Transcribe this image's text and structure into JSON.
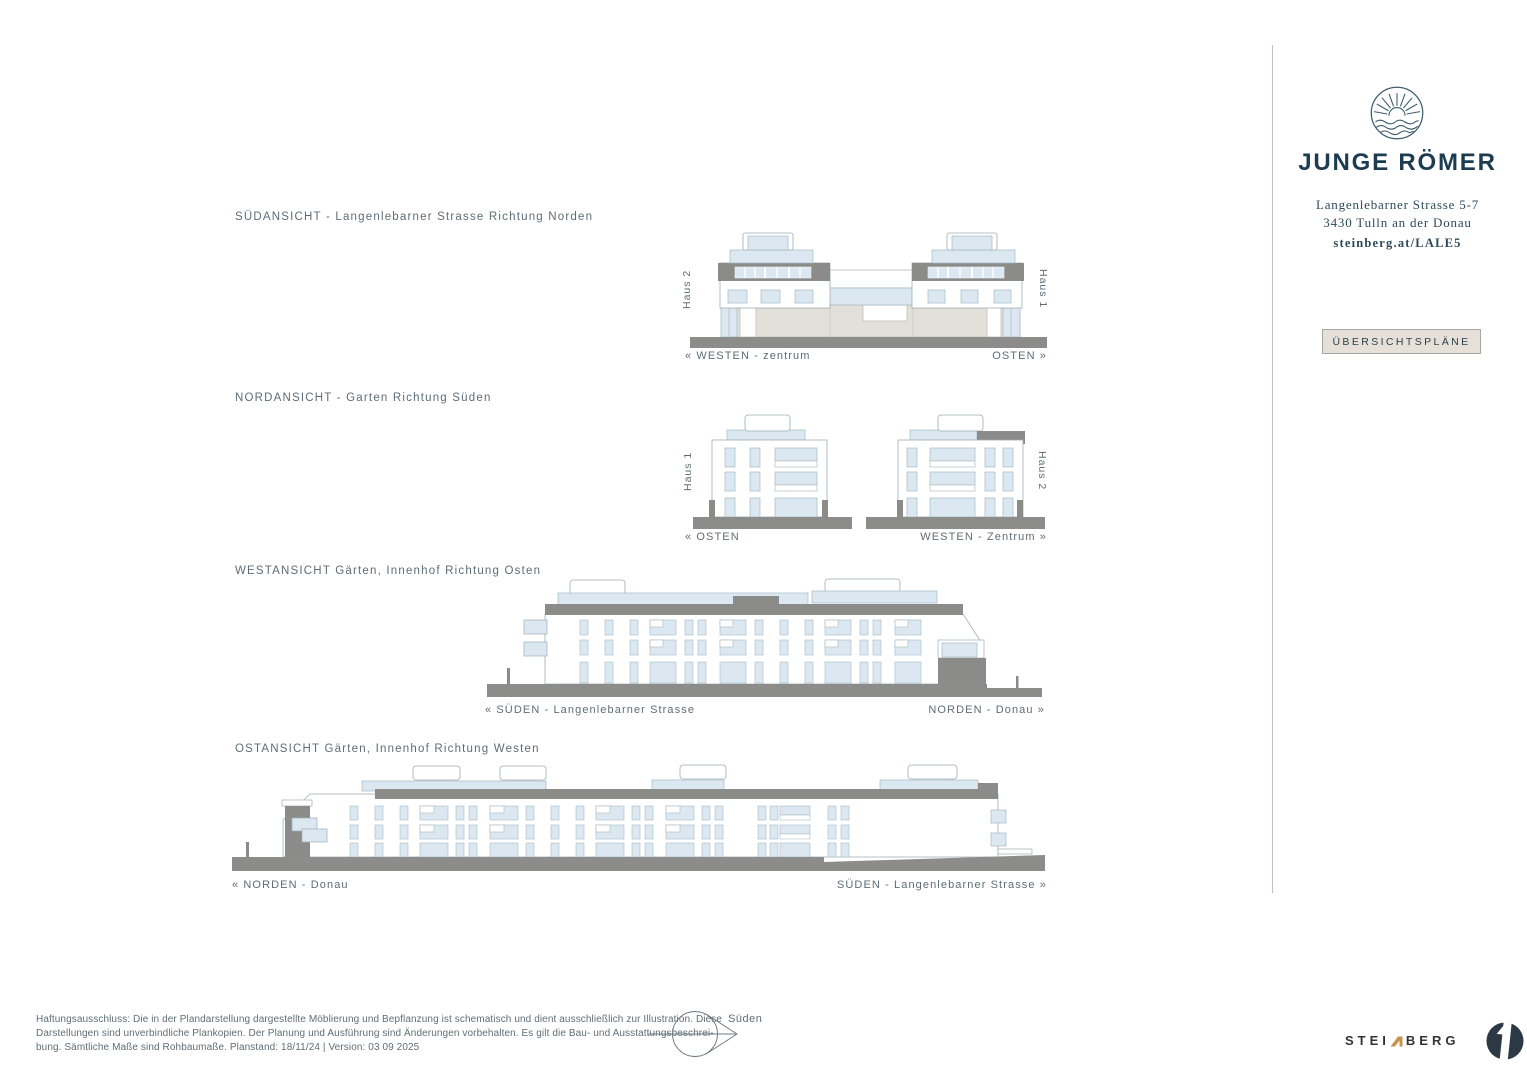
{
  "brand": {
    "logo_icon": "sun-waves-circle-icon",
    "name": "JUNGE RÖMER",
    "address_line1": "Langenlebarner Strasse 5-7",
    "address_line2": "3430 Tulln an der Donau",
    "link": "steinberg.at/LALE5",
    "overview_button_label": "ÜBERSICHTSPLÄNE"
  },
  "elevations": [
    {
      "title": "SÜDANSICHT - Langenlebarner Strasse Richtung Norden",
      "house_left": "Haus 2",
      "house_right": "Haus 1",
      "dir_left": "« WESTEN - zentrum",
      "dir_right": "OSTEN »"
    },
    {
      "title": "NORDANSICHT - Garten Richtung Süden",
      "house_left": "Haus 1",
      "house_right": "Haus 2",
      "dir_left": "« OSTEN",
      "dir_right": "WESTEN - Zentrum »"
    },
    {
      "title": "WESTANSICHT Gärten, Innenhof Richtung Osten",
      "dir_left": "« SÜDEN - Langenlebarner Strasse",
      "dir_right": "NORDEN - Donau »"
    },
    {
      "title": "OSTANSICHT Gärten, Innenhof Richtung Westen",
      "dir_left": "« NORDEN - Donau",
      "dir_right": "SÜDEN - Langenlebarner Strasse »"
    }
  ],
  "compass": {
    "icon": "north-arrow-icon",
    "label": "Süden"
  },
  "disclaimer": {
    "line1": "Haftungsausschluss: Die in der Plandarstellung dargestellte Möblierung und Bepflanzung ist schematisch und dient ausschließlich zur Illustration. Diese",
    "line2": "Darstellungen sind unverbindliche Plankopien. Der Planung und Ausführung sind Änderungen vorbehalten. Es gilt die Bau- und Ausstattungsbeschrei-",
    "line3": "bung. Sämtliche Maße sind Rohbaumaße. Planstand: 18/11/24  |  Version: 03 09 2025"
  },
  "footer": {
    "steinberg_left": "STEI",
    "steinberg_right": "BERG",
    "n_icon": "steinberg-roof-n-icon",
    "mark_icon": "steinberg-circle-icon"
  },
  "colors": {
    "brand_navy": "#1e3c50",
    "label_gray": "#5e6d75",
    "button_beige": "#e7e0d8",
    "drawing_dark_gray": "#8b8b89",
    "drawing_glass_blue": "#dbe8f1",
    "drawing_beige": "#e3dfd9",
    "accent_orange": "#c9924f"
  }
}
